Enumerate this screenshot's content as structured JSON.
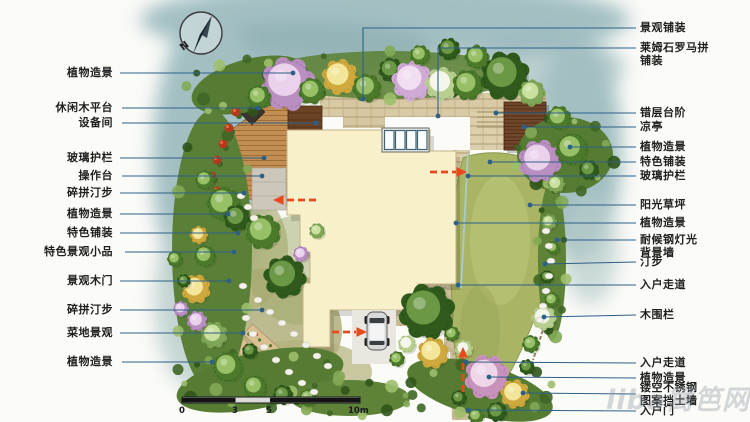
{
  "plan": {
    "left_labels": [
      {
        "text": "植物造景",
        "y": 73,
        "line": [
          [
            120,
            73
          ],
          [
            293,
            73
          ]
        ]
      },
      {
        "text": "休闲木平台",
        "y": 108,
        "line": [
          [
            122,
            108
          ],
          [
            258,
            108
          ]
        ]
      },
      {
        "text": "设备间",
        "y": 123,
        "line": [
          [
            122,
            123
          ],
          [
            316,
            123
          ]
        ]
      },
      {
        "text": "玻璃护栏",
        "y": 158,
        "line": [
          [
            120,
            158
          ],
          [
            264,
            158
          ]
        ]
      },
      {
        "text": "操作台",
        "y": 176,
        "line": [
          [
            122,
            176
          ],
          [
            262,
            176
          ]
        ]
      },
      {
        "text": "碎拼汀步",
        "y": 193,
        "line": [
          [
            120,
            193
          ],
          [
            244,
            193
          ]
        ]
      },
      {
        "text": "植物造景",
        "y": 214,
        "line": [
          [
            120,
            214
          ],
          [
            228,
            214
          ]
        ]
      },
      {
        "text": "特色铺装",
        "y": 233,
        "line": [
          [
            120,
            233
          ],
          [
            238,
            233
          ]
        ]
      },
      {
        "text": "特色景观小品",
        "y": 252,
        "line": [
          [
            125,
            252
          ],
          [
            234,
            252
          ]
        ]
      },
      {
        "text": "景观木门",
        "y": 281,
        "line": [
          [
            120,
            281
          ],
          [
            229,
            281
          ]
        ]
      },
      {
        "text": "碎拼汀步",
        "y": 310,
        "line": [
          [
            120,
            310
          ],
          [
            262,
            310
          ]
        ]
      },
      {
        "text": "菜地景观",
        "y": 333,
        "line": [
          [
            120,
            333
          ],
          [
            243,
            333
          ]
        ]
      },
      {
        "text": "植物造景",
        "y": 362,
        "line": [
          [
            122,
            362
          ],
          [
            212,
            362
          ]
        ]
      }
    ],
    "right_labels": [
      {
        "text": "景观铺装",
        "y": 28,
        "line": [
          [
            636,
            28
          ],
          [
            363,
            28
          ],
          [
            363,
            99
          ]
        ]
      },
      {
        "text": "莱姆石罗马拼\n铺装",
        "y": 48,
        "ty": 41,
        "line": [
          [
            636,
            48
          ],
          [
            438,
            48
          ],
          [
            438,
            116
          ]
        ]
      },
      {
        "text": "错层台阶",
        "y": 113,
        "line": [
          [
            636,
            113
          ],
          [
            496,
            113
          ]
        ]
      },
      {
        "text": "凉亭",
        "y": 127,
        "line": [
          [
            636,
            127
          ],
          [
            524,
            127
          ]
        ]
      },
      {
        "text": "植物造景",
        "y": 147,
        "line": [
          [
            636,
            147
          ],
          [
            570,
            147
          ]
        ]
      },
      {
        "text": "特色铺装",
        "y": 162,
        "line": [
          [
            636,
            162
          ],
          [
            490,
            162
          ]
        ]
      },
      {
        "text": "玻璃护栏",
        "y": 176,
        "line": [
          [
            636,
            176
          ],
          [
            468,
            176
          ]
        ]
      },
      {
        "text": "阳光草坪",
        "y": 205,
        "line": [
          [
            636,
            205
          ],
          [
            530,
            205
          ]
        ]
      },
      {
        "text": "植物造景",
        "y": 223,
        "line": [
          [
            636,
            223
          ],
          [
            456,
            223
          ]
        ]
      },
      {
        "text": "耐候钢灯光\n背景墙",
        "y": 240,
        "ty": 233,
        "line": [
          [
            636,
            240
          ],
          [
            557,
            240
          ]
        ]
      },
      {
        "text": "汀步",
        "y": 262,
        "line": [
          [
            636,
            262
          ],
          [
            545,
            264
          ]
        ]
      },
      {
        "text": "入户走道",
        "y": 285,
        "line": [
          [
            636,
            285
          ],
          [
            458,
            285
          ]
        ]
      },
      {
        "text": "木围栏",
        "y": 315,
        "line": [
          [
            636,
            315
          ],
          [
            544,
            317
          ]
        ]
      },
      {
        "text": "入户走道",
        "y": 363,
        "line": [
          [
            636,
            363
          ],
          [
            466,
            362
          ]
        ]
      },
      {
        "text": "植物造景",
        "y": 378,
        "line": [
          [
            636,
            378
          ],
          [
            489,
            377
          ]
        ]
      },
      {
        "text": "镂空不锈钢\n图案挡土墙",
        "y": 394,
        "ty": 381,
        "line": [
          [
            636,
            394
          ],
          [
            523,
            393
          ]
        ]
      },
      {
        "text": "入户门",
        "y": 411,
        "line": [
          [
            636,
            411
          ],
          [
            468,
            410
          ]
        ]
      }
    ]
  },
  "compass": {
    "label": "N"
  },
  "scale_bar": {
    "ticks": [
      "0",
      "3",
      "5",
      "10m"
    ]
  },
  "watermark": {
    "text": "liba篱笆网"
  },
  "colors": {
    "leader": "#2d6089",
    "label_text": "#1f1f1f",
    "arrow": "#e8481a",
    "wash": "#a3bfc2",
    "house": "#f8f0cb",
    "lawn": "#a9b464",
    "deck": "#c28e52",
    "pavilion": "#71462a",
    "path": "#d8caa5"
  }
}
